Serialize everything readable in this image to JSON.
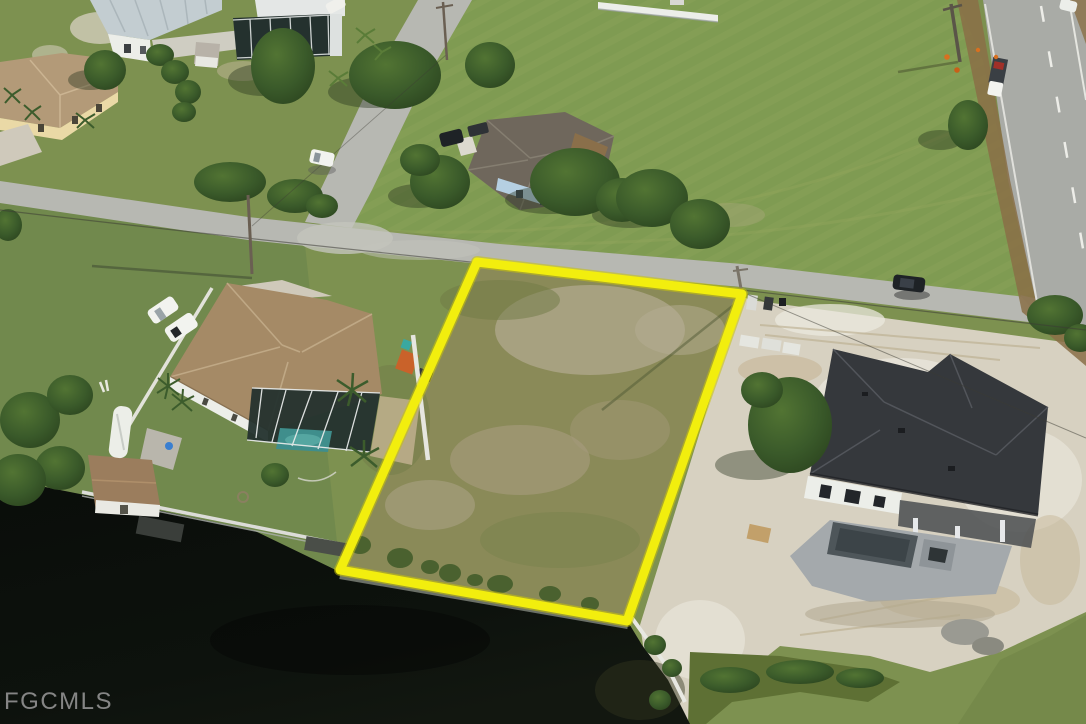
{
  "watermark": {
    "text": "FGCMLS",
    "color": "#9a9a9a"
  },
  "palette": {
    "grass": "#7d9150",
    "grass_dark": "#6a8446",
    "field": "#7f9b52",
    "lot_ground": "#8a8a58",
    "road": "#b7b8b2",
    "highway": "#a9aba6",
    "shoulder_dirt": "#8a6f46",
    "sand": "#d7d1c1",
    "sand_bright": "#ebe8de",
    "sand_tan": "#c4b392",
    "water": "#0c100c",
    "seawall": "#6a6f66",
    "seawall_white": "#e8e8e2",
    "lot_outline": "#f2ee0e",
    "roof_tan": "#a58a66",
    "roof_taupe": "#6f675c",
    "roof_charcoal": "#35383c",
    "roof_tl_house": "#b39a78",
    "metal_roof": "#c3cdd1",
    "wall_white": "#eceee9",
    "wall_cream": "#ead9a6",
    "wall_blue": "#b5cfe2",
    "pool_teal": "#3f8e8c",
    "pool_gray": "#4e565a",
    "screen_dark": "#24312e",
    "canopy": "#3a5a2a",
    "canopy_light": "#4e7030",
    "concrete": "#a4a9ac",
    "vehicle_white": "#f2f3ef",
    "vehicle_dark": "#1e2226",
    "safety_orange": "#d87020"
  }
}
